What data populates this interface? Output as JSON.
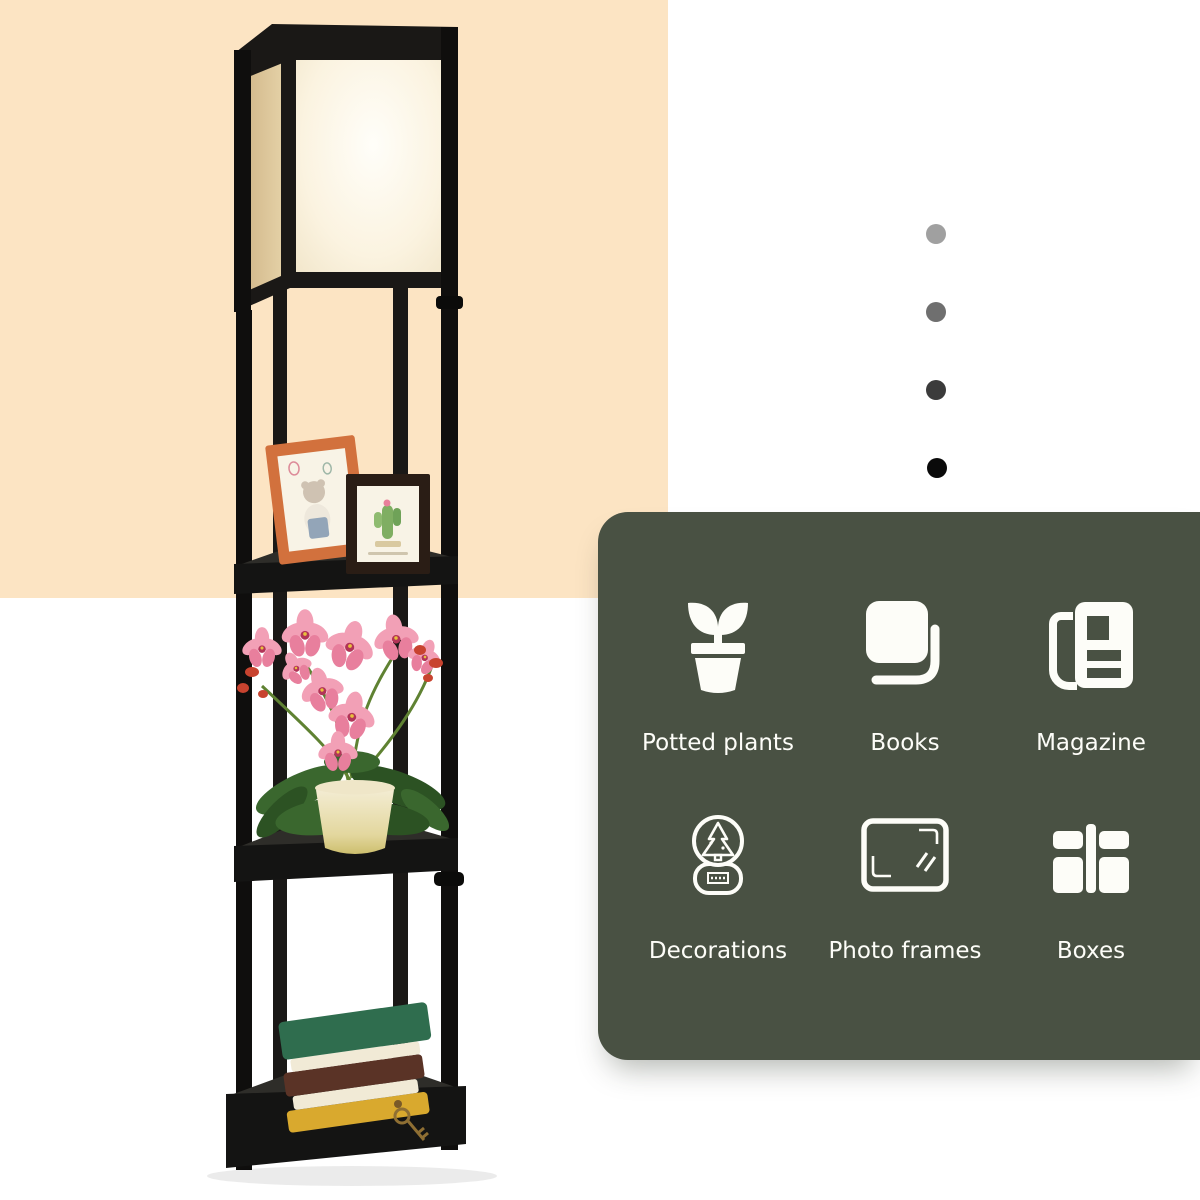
{
  "colors": {
    "page_bg": "#ffffff",
    "peach_block": "#fce4c3",
    "panel_bg": "#495143",
    "panel_text": "#fdfdf8",
    "lamp_frame": "#1a1816",
    "lamp_frame_dark": "#0f0e0d",
    "shelf_top": "#2e2d29",
    "shelf_front": "#141413",
    "stem_green": "#5f8232",
    "leaf_green": "#3a672e",
    "leaf_green_dark": "#2c5223",
    "flower_pink": "#f2a0b6",
    "flower_pink_deep": "#e87f9d",
    "flower_center": "#b23458",
    "bud_red": "#c8432f",
    "frame_orange": "#d2713d",
    "frame_dark_wood": "#2a1d15",
    "photo_paper": "#f8f3e6",
    "book_green": "#2f6d4e",
    "book_brown": "#5a3326",
    "book_yellow": "#d9a92e",
    "pages_cream": "#f1ead6",
    "key_gold": "#8f6f33"
  },
  "pagination_dots": {
    "colors": [
      "#a0a0a0",
      "#6f6f6f",
      "#3b3b3b",
      "#0a0a0a"
    ]
  },
  "panel": {
    "features": [
      {
        "label": "Potted plants",
        "icon": "potted-plant-icon"
      },
      {
        "label": "Books",
        "icon": "book-icon"
      },
      {
        "label": "Magazine",
        "icon": "magazine-icon"
      },
      {
        "label": "Decorations",
        "icon": "snow-globe-icon"
      },
      {
        "label": "Photo frames",
        "icon": "photo-frame-icon"
      },
      {
        "label": "Boxes",
        "icon": "boxes-icon"
      }
    ]
  },
  "product_photo": {
    "alt": "Black etagere shelf floor lamp with lit fabric shade, photo frames, pink orchid plant and stacked books on its shelves"
  }
}
